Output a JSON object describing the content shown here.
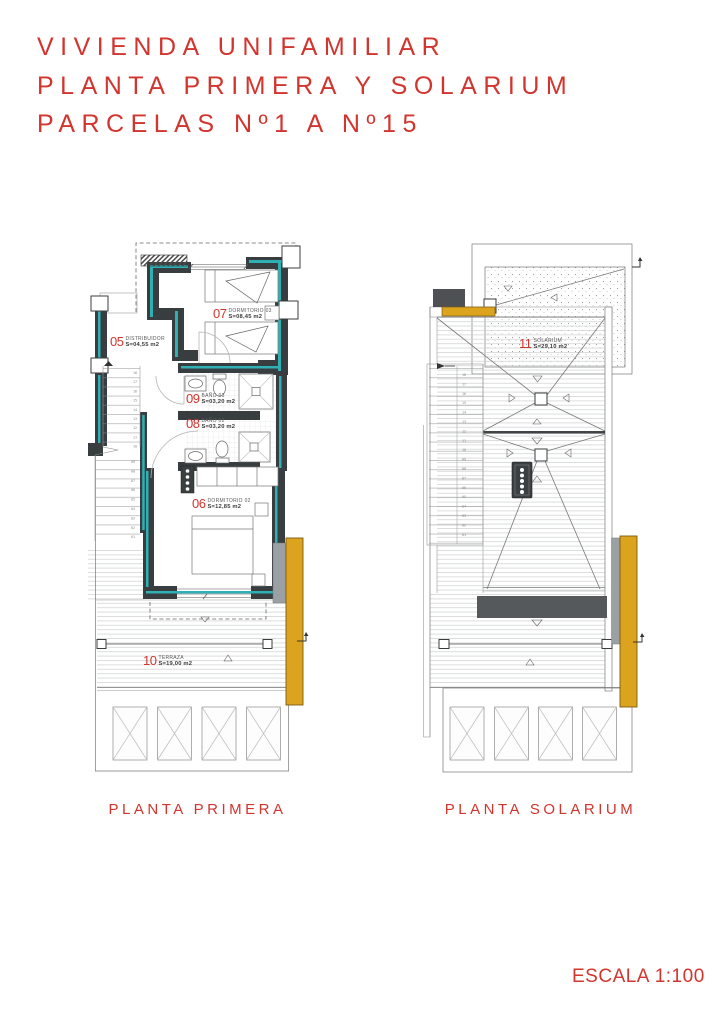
{
  "sheet": {
    "title_lines": [
      "VIVIENDA UNIFAMILIAR",
      "PLANTA PRIMERA Y SOLARIUM",
      "PARCELAS Nº1 A Nº15"
    ],
    "scale": "ESCALA 1:100"
  },
  "colors": {
    "red": "#d2342e",
    "teal": "#2fb0b4",
    "orange": "#dca31f",
    "wall": "#383d40",
    "slab": "#55595c",
    "gray": "#9aa0a3"
  },
  "plans": [
    {
      "caption": "PLANTA PRIMERA",
      "rooms": [
        {
          "num": "05",
          "name": "DISTRIBUIDOR",
          "area": "S=04,55 m2"
        },
        {
          "num": "07",
          "name": "DORMITORIO 03",
          "area": "S=08,45 m2"
        },
        {
          "num": "09",
          "name": "BAÑO 03",
          "area": "S=03,20 m2"
        },
        {
          "num": "08",
          "name": "BAÑO 02",
          "area": "S=03,20 m2"
        },
        {
          "num": "06",
          "name": "DORMITORIO 02",
          "area": "S=12,85 m2"
        },
        {
          "num": "10",
          "name": "TERRAZA",
          "area": "S=19,00 m2"
        }
      ],
      "stair_numbers_upper": [
        "18",
        "17",
        "16",
        "15",
        "14",
        "13",
        "12",
        "11",
        "10"
      ],
      "stair_numbers_lower": [
        "09",
        "08",
        "07",
        "06",
        "05",
        "04",
        "03",
        "02",
        "01"
      ]
    },
    {
      "caption": "PLANTA SOLARIUM",
      "rooms": [
        {
          "num": "11",
          "name": "SOLARIUM",
          "area": "S=29,10 m2"
        }
      ],
      "stair_numbers": [
        "18",
        "17",
        "16",
        "15",
        "14",
        "13",
        "12",
        "11",
        "10",
        "09",
        "08",
        "07",
        "06",
        "05",
        "04",
        "03",
        "02",
        "01"
      ]
    }
  ]
}
